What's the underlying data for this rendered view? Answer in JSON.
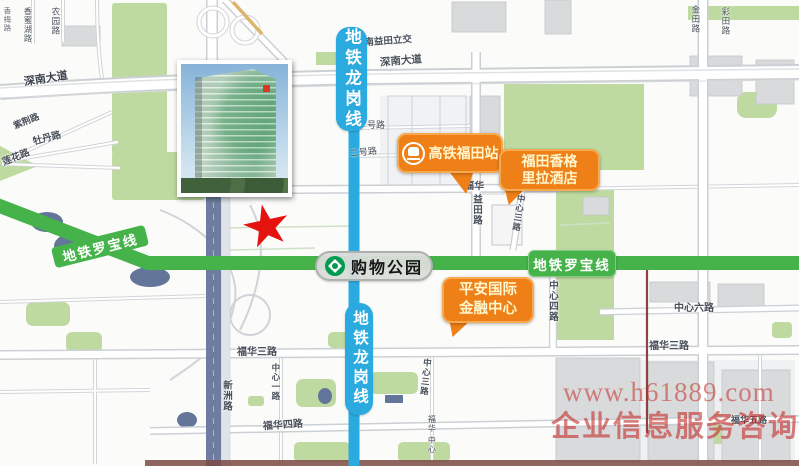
{
  "map": {
    "metro": {
      "longgang": {
        "name": "地铁龙岗线",
        "color": "#2baadf"
      },
      "luobao": {
        "name": "地铁罗宝线",
        "color": "#45b34a"
      },
      "station": {
        "name": "购物公园",
        "logo": "shenzhen-metro-logo"
      }
    },
    "pois": {
      "hsr": {
        "label": "高铁福田站",
        "icon": "train-icon",
        "color": "#ef7f17"
      },
      "hotel": {
        "line1": "福田香格",
        "line2": "里拉酒店",
        "color": "#ef7f17"
      },
      "pingan": {
        "line1": "平安国际",
        "line2": "金融中心",
        "color": "#ef7f17"
      }
    },
    "marker": {
      "type": "red-star",
      "color": "#e41310"
    },
    "roads": [
      {
        "text": "深南大道"
      },
      {
        "text": "深南益田立交"
      },
      {
        "text": "深南大道"
      },
      {
        "text": "号路"
      },
      {
        "text": "二号路"
      },
      {
        "text": "福华"
      },
      {
        "text": "益田路"
      },
      {
        "text": "中心三路"
      },
      {
        "text": "中心四路"
      },
      {
        "text": "中心六路"
      },
      {
        "text": "福华三路"
      },
      {
        "text": "福华三路"
      },
      {
        "text": "福华四路"
      },
      {
        "text": "福华五路"
      },
      {
        "text": "新洲路"
      },
      {
        "text": "中心一路"
      },
      {
        "text": "中心三路"
      },
      {
        "text": "紫荆路"
      },
      {
        "text": "牡丹路"
      },
      {
        "text": "莲花路"
      },
      {
        "text": "香蜜湖路"
      },
      {
        "text": "农园路"
      },
      {
        "text": "金田路"
      },
      {
        "text": "彩田路"
      },
      {
        "text": "福华"
      },
      {
        "text": "中心"
      },
      {
        "text": "香梅路"
      }
    ]
  },
  "watermark": {
    "line1": "www.h61889.com",
    "line2": "企业信息服务咨询"
  },
  "colors": {
    "metro_blue": "#2baadf",
    "metro_green": "#45b34a",
    "poi_orange": "#ef7f17",
    "star_red": "#e41310",
    "park_green": "#bedaa1",
    "xinzhou_road": "#6e7d9f",
    "watermark_red": "#c52c28"
  }
}
